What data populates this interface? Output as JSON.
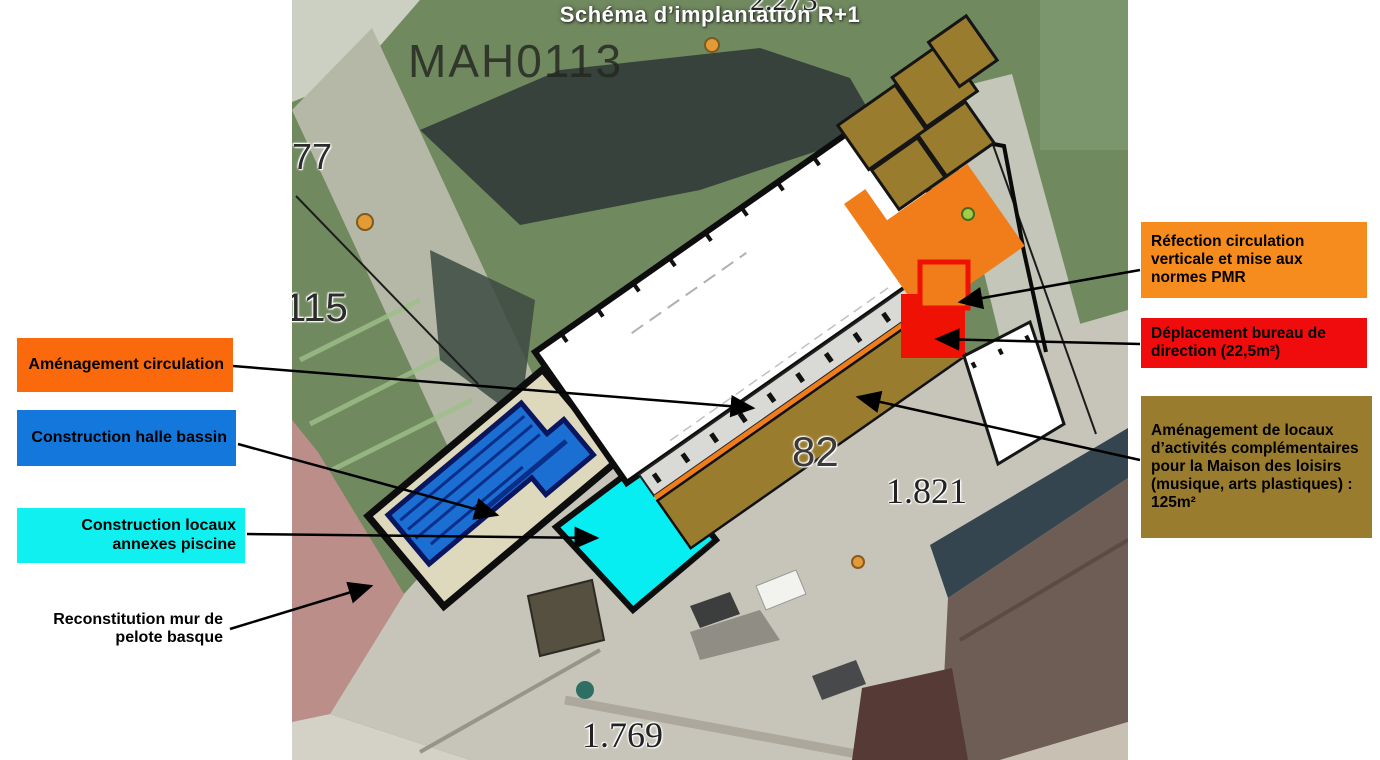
{
  "title": "Schéma d’implantation R+1",
  "legend_left": [
    {
      "label": "Aménagement circulation",
      "color": "#fa6a0d"
    },
    {
      "label": "Construction halle bassin",
      "color": "#1477db"
    },
    {
      "label": "Construction locaux annexes piscine",
      "color": "#11f0f0"
    },
    {
      "label": "Reconstitution mur de pelote basque",
      "color": null
    }
  ],
  "legend_right": [
    {
      "label": "Réfection circulation verticale et mise aux normes PMR",
      "color": "#f68c1e"
    },
    {
      "label": "Déplacement bureau de direction (22,5m²)",
      "color": "#f00c0c"
    },
    {
      "label": "Aménagement de locaux d’activités complémentaires pour la Maison des loisirs (musique, arts plastiques) : 125m²",
      "color": "#9a7c2e"
    }
  ],
  "map_labels": {
    "parcel_code": "MAH0113",
    "num_77": "77",
    "num_115": "115",
    "num_82": "82",
    "num_1821": "1.821",
    "num_1769": "1.769",
    "num_top_partial": "2.273"
  },
  "map_colors": {
    "hall_white": "#ffffff",
    "pool_blue": "#1b6fd3",
    "annex_cyan": "#06eef2",
    "circulation_orange": "#f07d1a",
    "bureau_red": "#ee1104",
    "locaux_brown": "#9a7c2e",
    "annex_beige": "#ded9bc",
    "pelote_pink": "#bc8e89"
  }
}
